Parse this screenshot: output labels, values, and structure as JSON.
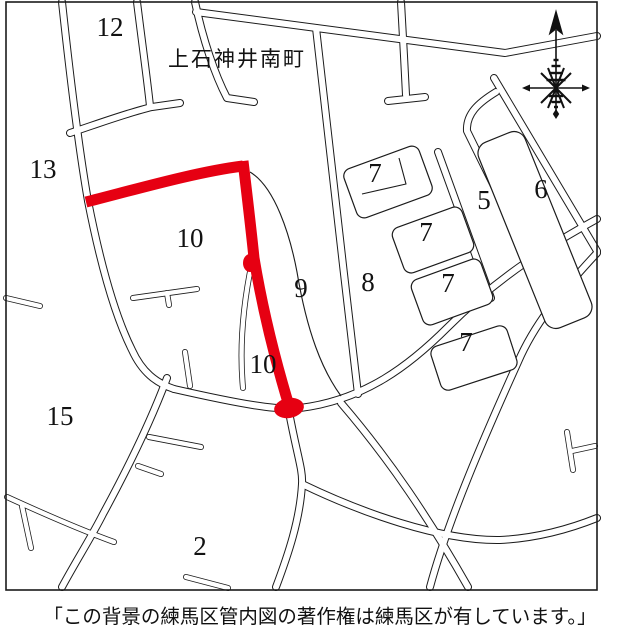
{
  "map": {
    "area_label": "上石神井南町",
    "labels": [
      {
        "text": "12",
        "x": 110,
        "y": 36
      },
      {
        "text": "13",
        "x": 43,
        "y": 178
      },
      {
        "text": "10",
        "x": 190,
        "y": 247
      },
      {
        "text": "9",
        "x": 301,
        "y": 297
      },
      {
        "text": "10",
        "x": 263,
        "y": 373
      },
      {
        "text": "8",
        "x": 368,
        "y": 291
      },
      {
        "text": "7",
        "x": 375,
        "y": 182
      },
      {
        "text": "7",
        "x": 426,
        "y": 241
      },
      {
        "text": "7",
        "x": 448,
        "y": 292
      },
      {
        "text": "7",
        "x": 466,
        "y": 351
      },
      {
        "text": "5",
        "x": 484,
        "y": 209
      },
      {
        "text": "6",
        "x": 541,
        "y": 198
      },
      {
        "text": "15",
        "x": 60,
        "y": 425
      },
      {
        "text": "2",
        "x": 200,
        "y": 555
      }
    ],
    "route_color": "#e60012",
    "road_outline_color": "#1b1b1b",
    "compass_icon": "compass-rose-north-arrow"
  },
  "caption": "「この背景の練馬区管内図の著作権は練馬区が有しています。」"
}
